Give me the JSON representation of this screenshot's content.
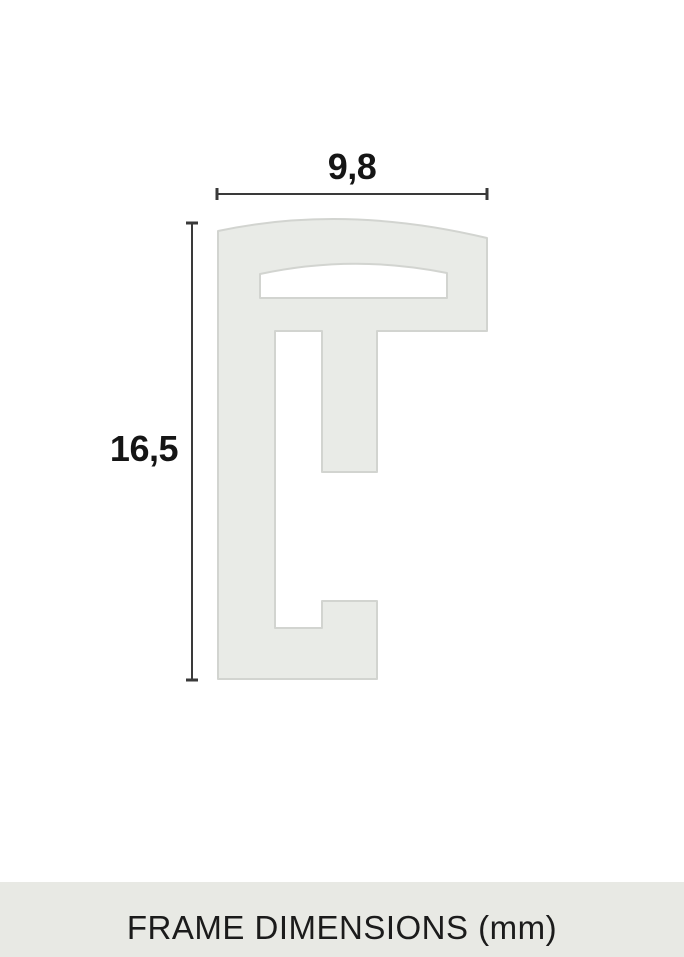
{
  "diagram": {
    "width_label": "9,8",
    "height_label": "16,5",
    "width_value_mm": 9.8,
    "height_value_mm": 16.5,
    "unit": "mm",
    "caption": "FRAME DIMENSIONS (mm)"
  },
  "geometry": {
    "profile_path": "M 218 231 Q 345 204 487 238 L 487 331 L 377 331 L 377 472 L 322 472 L 322 331 L 275 331 L 275 628 L 322 628 L 322 601 L 377 601 L 377 679 L 218 679 Z M 260 298 L 260 274 Q 353 254 447 273 L 447 298 Z"
  },
  "colors": {
    "background": "#ffffff",
    "profile_fill": "#e9ebe7",
    "profile_outline": "#d2d4d0",
    "dimension_line": "#3a3a3a",
    "label_text": "#151515",
    "caption_bar_background": "#e8e9e4",
    "caption_text": "#1b1b1b"
  }
}
